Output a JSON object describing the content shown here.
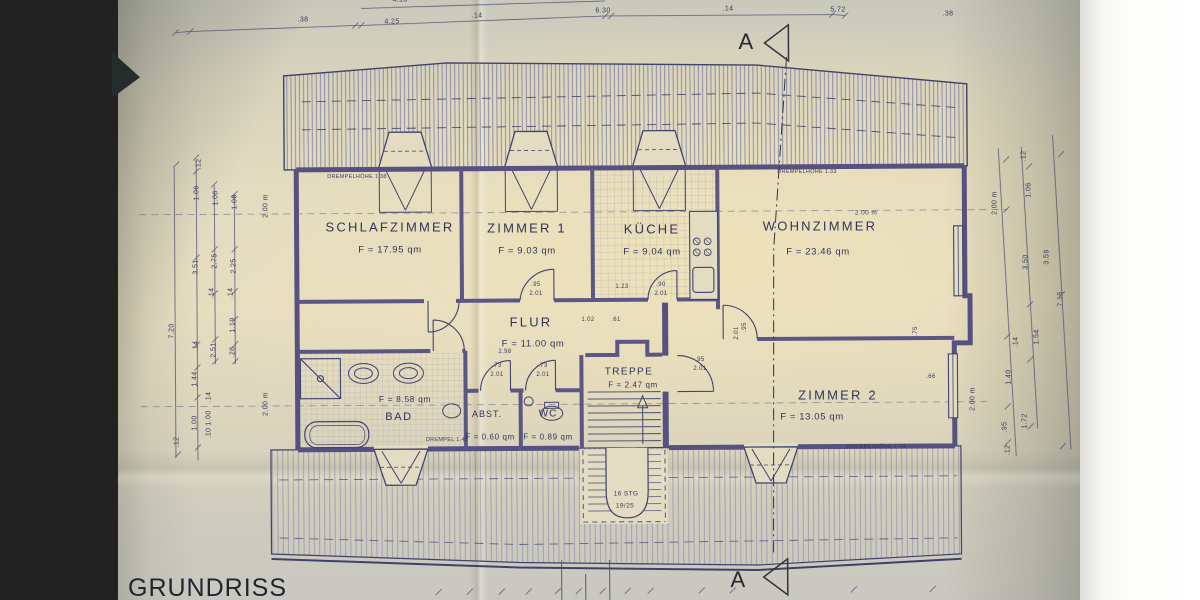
{
  "title": "GRUNDRISS",
  "section_marker": "A",
  "rooms": [
    {
      "name": "SCHLAFZIMMER",
      "area": "F = 17.95 qm"
    },
    {
      "name": "ZIMMER 1",
      "area": "F = 9.03 qm"
    },
    {
      "name": "KÜCHE",
      "area": "F = 9.04 qm"
    },
    {
      "name": "WOHNZIMMER",
      "area": "F =  23.46 qm"
    },
    {
      "name": "FLUR",
      "area": "F = 11.00 qm"
    },
    {
      "name": "TREPPE",
      "area": "F = 2.47 qm"
    },
    {
      "name": "BAD",
      "area": "F = 8.58 qm"
    },
    {
      "name": "ABST.",
      "area": "F = 0.60 qm"
    },
    {
      "name": "WC",
      "area": "F = 0.89 qm"
    },
    {
      "name": "ZIMMER 2",
      "area": "F = 13.05 qm"
    }
  ],
  "annotations": {
    "drempel_left": "DREMPELHÖHE 1.38",
    "drempel_right": "DREMPELHÖHE 1.33",
    "drempel_bad": "DREMPEL 1.42",
    "drempel_zimmer2": "DREMPELHÖHE 1.44",
    "stairs_line1": "16 STG",
    "stairs_line2": "19/25"
  },
  "dims": {
    "top": [
      ".38",
      "4.25",
      ".14",
      "6.30",
      ".14",
      "5.72",
      ".38"
    ],
    "top_partial": "4.13",
    "left": [
      "7.20",
      ".12",
      "1.06",
      "1.06",
      "1.06",
      "2.00 m",
      "3.51",
      "2.75",
      "2.25",
      ".14",
      ".14",
      "1.19",
      ".28",
      "2.51",
      ".14",
      "1.44",
      ".14",
      "1.00",
      ".10",
      "1.00",
      ".12",
      "2.00 m"
    ],
    "right": [
      ".12",
      "1.06",
      "2.00 m",
      "3.50",
      "3.59",
      "7.15",
      ".14",
      "1.54",
      "1.40",
      "1.72",
      ".95",
      ".12",
      "2.00 m"
    ],
    "inner": [
      "2.98",
      "1.02",
      ".61",
      ".73",
      "2.01",
      ".73",
      "2.01",
      ".95",
      "2.01",
      "1.23",
      ".90",
      "2.01",
      ".95",
      "2.01",
      ".95",
      "2.01",
      ".75",
      ".66",
      "2.00 m"
    ]
  },
  "colors": {
    "ink": "#3f4169",
    "paper": "#e3dcc2",
    "background": "#3d423f"
  }
}
